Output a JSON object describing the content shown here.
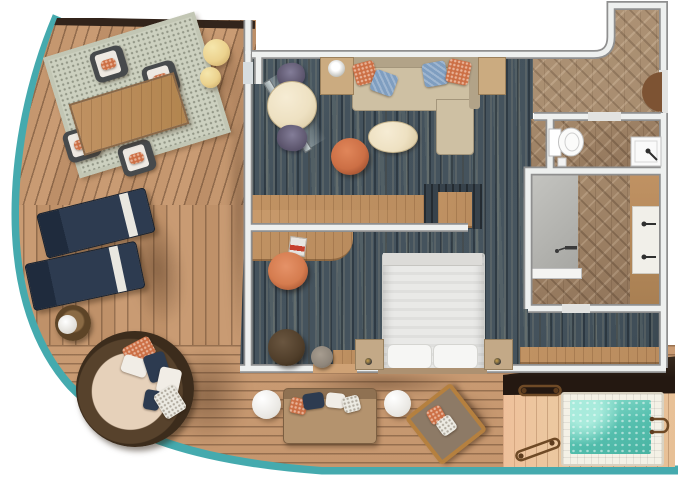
{
  "scene": {
    "kind": "cruise-ship-suite-floor-plan",
    "view": "top-down"
  },
  "colors": {
    "railing_teal": "#45aaae",
    "deck_wood": "#c5976f",
    "deck_wood_light": "#eecba4",
    "carpet_blue": "#44525c",
    "herringbone_wood": "#9b8066",
    "hall_wood": "#b59a7c",
    "wall_fill": "#eef0ef",
    "wall_line": "#8f8f8f",
    "hot_tub_water": "#55bfae",
    "sofa_beige": "#cec0a3",
    "table_cream": "#eee1c2",
    "accent_orange": "#cc6f45",
    "pillow_blue": "#7f9ec0",
    "chair_purple": "#615a72",
    "lounger_navy": "#2d3b50",
    "pouf_yellow": "#ecd28e",
    "wood_furniture": "#b98c5e",
    "balcony_wall_dark": "#32241b",
    "outdoor_bench_dark": "#241811",
    "bed_white": "#e9e9e7",
    "daybed_wicker": "#503c28",
    "daybed_cushion": "#e6d1ba"
  },
  "rooms": [
    {
      "id": "wraparound-balcony",
      "floor": "teak-deck",
      "items": [
        "outdoor-dining-table",
        "outdoor-dining-chair",
        "outdoor-dining-chair",
        "outdoor-dining-chair",
        "outdoor-dining-chair",
        "outdoor-rug",
        "pouf",
        "pouf",
        "sun-lounger",
        "sun-lounger",
        "wicker-side-table",
        "round-daybed",
        "outdoor-sofa",
        "round-side-table",
        "round-side-table",
        "wood-lounge-chair",
        "hot-tub",
        "hot-tub-rails",
        "dark-bench"
      ]
    },
    {
      "id": "living-room",
      "floor": "blue-patterned-carpet",
      "items": [
        "sectional-sofa",
        "lamp-side-table",
        "end-table",
        "round-table",
        "upholstered-chair",
        "upholstered-chair",
        "oval-coffee-table",
        "swivel-chair",
        "console-divider",
        "open-balcony-door"
      ]
    },
    {
      "id": "bedroom",
      "floor": "blue-patterned-carpet",
      "items": [
        "king-bed",
        "pillow",
        "pillow",
        "nightstand",
        "nightstand",
        "desk",
        "desk-chair",
        "book",
        "ottoman",
        "small-round-table",
        "wardrobe",
        "balcony-door-threshold"
      ]
    },
    {
      "id": "entry-hall",
      "floor": "herringbone-wood",
      "items": [
        "entry-door"
      ]
    },
    {
      "id": "water-closet",
      "floor": "herringbone-wood",
      "items": [
        "toilet",
        "hand-sink"
      ]
    },
    {
      "id": "bathroom",
      "floor": "herringbone-wood",
      "items": [
        "walk-in-shower",
        "vanity-counter"
      ]
    }
  ]
}
